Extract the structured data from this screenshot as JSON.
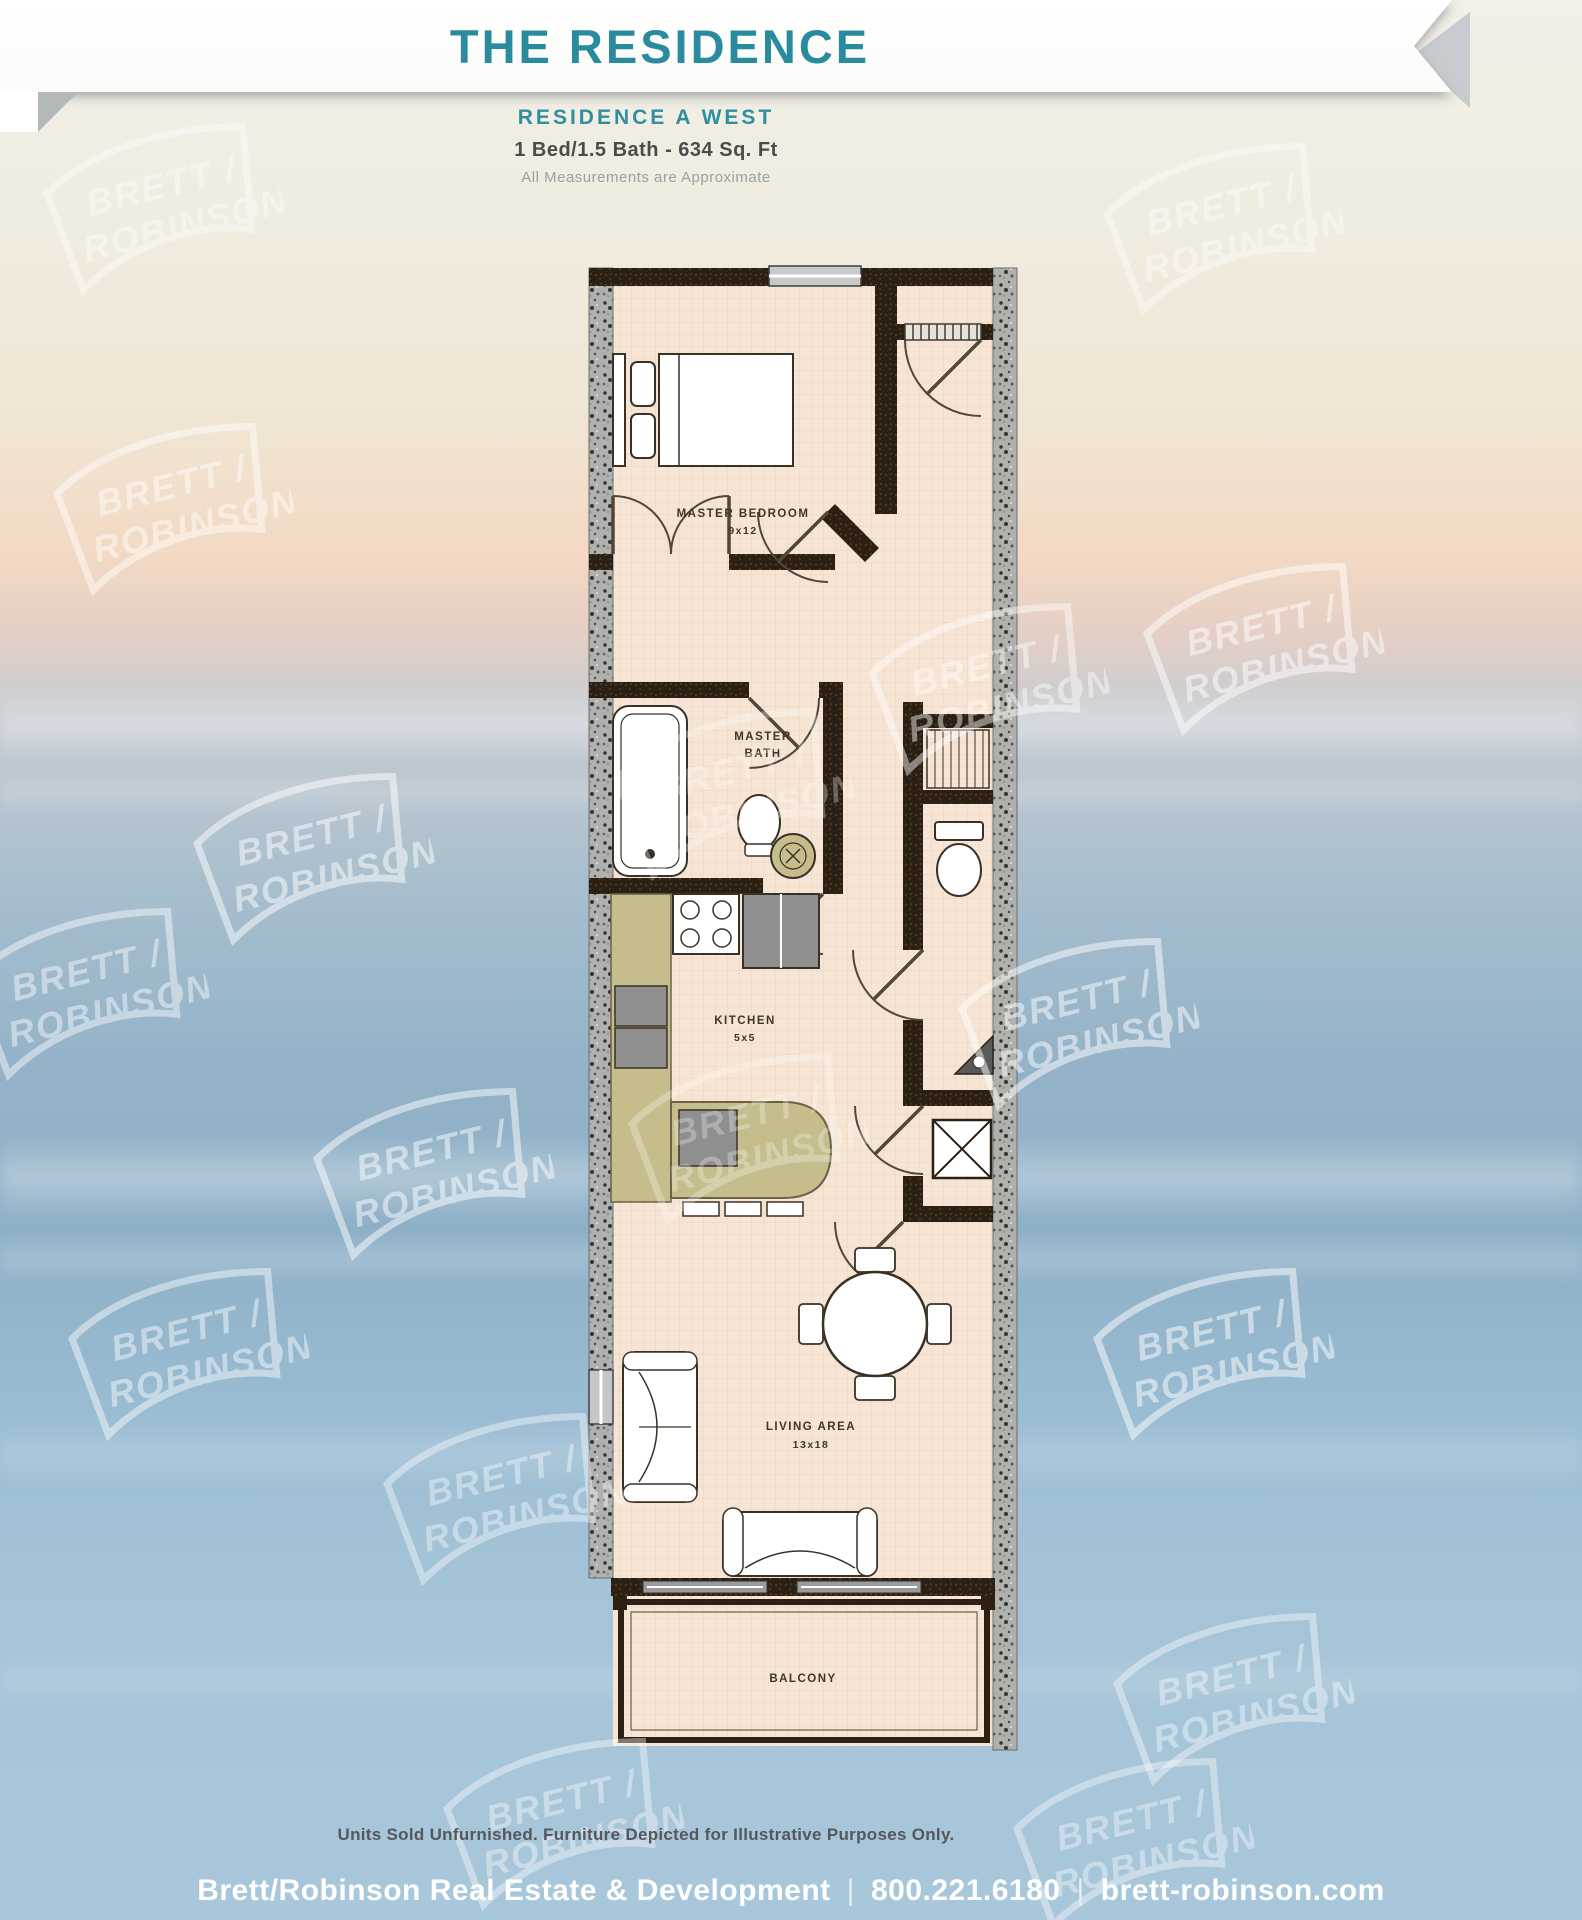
{
  "header": {
    "title": "THE RESIDENCE"
  },
  "plan_info": {
    "name": "RESIDENCE  A WEST",
    "specs": "1 Bed/1.5 Bath - 634 Sq. Ft",
    "note": "All Measurements are Approximate"
  },
  "floorplan": {
    "master_bedroom_label": "MASTER BEDROOM",
    "master_bedroom_dims": "9x12",
    "master_bath_label_1": "MASTER",
    "master_bath_label_2": "BATH",
    "kitchen_label": "KITCHEN",
    "kitchen_dims": "5x5",
    "living_label": "LIVING AREA",
    "living_dims": "13x18",
    "balcony_label": "BALCONY"
  },
  "watermark": {
    "line1": "BRETT /",
    "line2": "ROBINSON"
  },
  "footer": {
    "disclaimer": "Units Sold Unfurnished. Furniture Depicted for Illustrative Purposes Only.",
    "company": "Brett/Robinson Real Estate & Development",
    "phone": "800.221.6180",
    "website": "brett-robinson.com",
    "separator": "|"
  },
  "colors": {
    "teal": "#2b8b9e",
    "wall_dark": "#2b2013",
    "concrete_gray": "#b0b0ae",
    "floor": "#f6e5d4",
    "counter_olive": "#c5bd8c"
  }
}
